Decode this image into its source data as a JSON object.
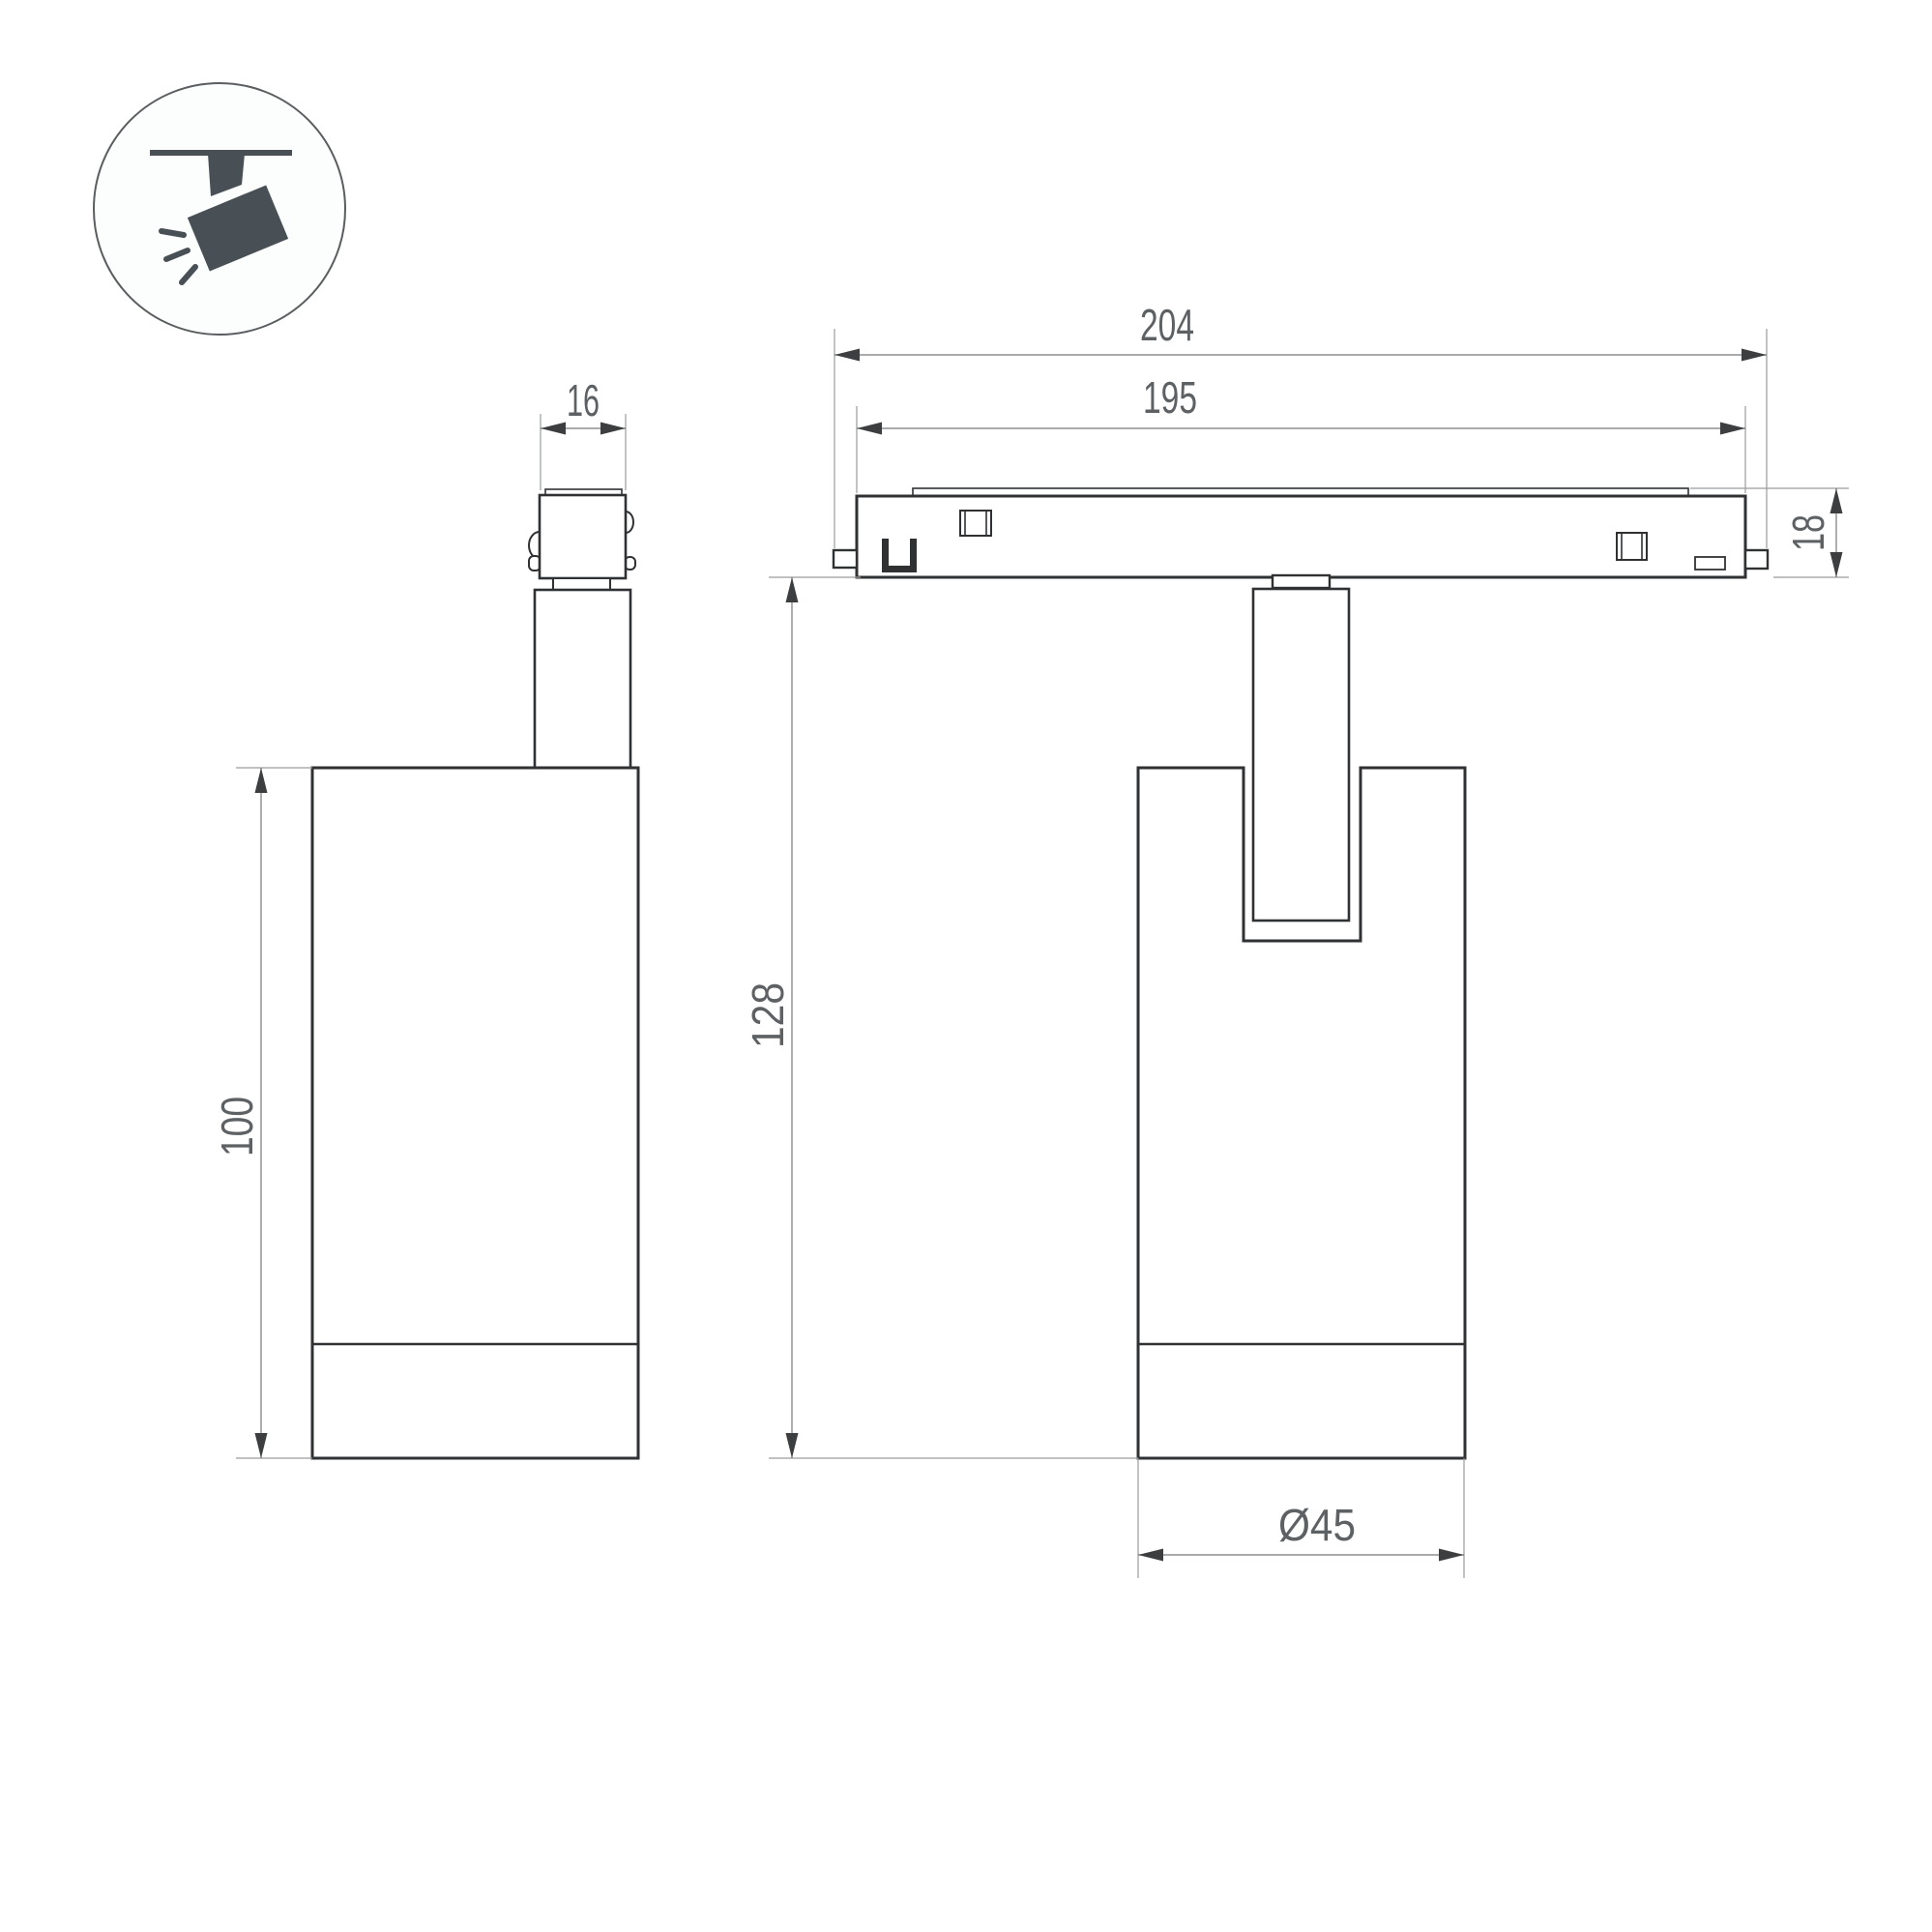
{
  "drawing": {
    "type": "luminaire technical drawing, side and front orthographic views",
    "icon": {
      "label": "ceiling track spotlight pictogram"
    },
    "dimensions": {
      "adapter_width": "16",
      "track_length_overall": "204",
      "track_length_inner": "195",
      "track_height": "18",
      "body_height": "100",
      "overall_height": "128",
      "body_diameter": "Ø45"
    },
    "colors": {
      "background": "#ffffff",
      "outline": "#2f3133",
      "extension_line": "#9a9c9d",
      "dimension_line": "#77797b",
      "arrow": "#3c3e40",
      "label_text": "#5d6164",
      "icon": "#485055"
    }
  }
}
